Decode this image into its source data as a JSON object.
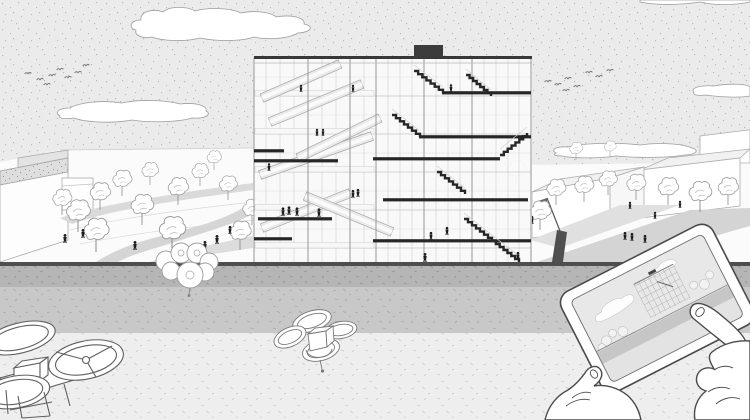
{
  "meta": {
    "title": "Architectural section-perspective illustration with plaza, drones and tablet overlay",
    "canvas": {
      "width": 750,
      "height": 420
    }
  },
  "palette": {
    "sky": "#ebebeb",
    "skyDot": "#aeaeae",
    "cloudFill": "#ffffff",
    "cloudStroke": "#9e9e9e",
    "ground": "#fbfbfb",
    "path": "#d5d5d5",
    "roof": "#dedede",
    "outline": "#a8a8a8",
    "slab": "#262626",
    "grid": "#c4c4c4",
    "gridDark": "#979797",
    "ramp": "#e9e9e9",
    "figure": "#1d1d1d",
    "treeStroke": "#9a9a9a",
    "edge": "#4e4e4e",
    "band1": "#b5b5b5",
    "band2": "#c8c8c8",
    "band3": "#eeeeee",
    "bandTick": "#a6a6a6",
    "droneStroke": "#5f5f5f",
    "handStroke": "#4a4a4a",
    "screenSky": "#e8e8e8",
    "screenBand": "#c6c6c6"
  },
  "sky": {
    "horizon_y": 263
  },
  "clouds": {
    "count": 5,
    "names": [
      "cloud-top-left",
      "cloud-mid-left",
      "cloud-right-low",
      "cloud-right-edge",
      "cloud-top-right-sliver"
    ]
  },
  "birds": {
    "flock_left": [
      [
        28,
        74
      ],
      [
        40,
        80
      ],
      [
        52,
        76
      ],
      [
        47,
        85
      ],
      [
        60,
        70
      ],
      [
        68,
        78
      ],
      [
        78,
        73
      ],
      [
        86,
        66
      ]
    ],
    "flock_right": [
      [
        548,
        82
      ],
      [
        558,
        85
      ],
      [
        568,
        79
      ],
      [
        577,
        87
      ],
      [
        589,
        73
      ],
      [
        599,
        77
      ],
      [
        610,
        71
      ],
      [
        566,
        91
      ]
    ]
  },
  "trees": {
    "left": [
      [
        62,
        215,
        0.8
      ],
      [
        78,
        232,
        1.0
      ],
      [
        100,
        210,
        0.85
      ],
      [
        122,
        196,
        0.8
      ],
      [
        96,
        252,
        1.05
      ],
      [
        142,
        225,
        0.95
      ],
      [
        150,
        185,
        0.7
      ],
      [
        172,
        252,
        1.1
      ],
      [
        178,
        205,
        0.85
      ],
      [
        200,
        186,
        0.7
      ],
      [
        214,
        170,
        0.6
      ],
      [
        228,
        200,
        0.75
      ],
      [
        240,
        250,
        0.9
      ],
      [
        252,
        225,
        0.8
      ]
    ],
    "right": [
      [
        516,
        185,
        0.75
      ],
      [
        540,
        230,
        0.9
      ],
      [
        556,
        205,
        0.8
      ],
      [
        584,
        202,
        0.8
      ],
      [
        608,
        195,
        0.75
      ],
      [
        636,
        200,
        0.8
      ],
      [
        668,
        205,
        0.85
      ],
      [
        700,
        212,
        0.95
      ],
      [
        728,
        205,
        0.85
      ],
      [
        576,
        160,
        0.55
      ],
      [
        610,
        157,
        0.5
      ]
    ]
  },
  "people": {
    "plaza_left": [
      [
        65,
        243,
        1
      ],
      [
        83,
        238,
        1
      ],
      [
        135,
        250,
        1
      ],
      [
        205,
        250,
        1
      ],
      [
        217,
        244,
        1
      ],
      [
        230,
        234,
        0.9
      ]
    ],
    "plaza_right": [
      [
        532,
        224,
        0.9
      ],
      [
        630,
        209,
        0.8
      ],
      [
        655,
        219,
        0.8
      ],
      [
        625,
        240,
        0.9
      ],
      [
        632,
        241,
        0.9
      ],
      [
        645,
        243,
        0.9
      ],
      [
        680,
        208,
        0.8
      ]
    ],
    "building": [
      [
        451,
        92,
        0.85
      ],
      [
        317,
        136,
        0.8
      ],
      [
        323,
        136,
        0.8
      ],
      [
        283,
        216,
        0.95
      ],
      [
        289,
        215,
        0.95
      ],
      [
        297,
        216,
        0.95
      ],
      [
        319,
        217,
        0.95
      ],
      [
        353,
        198,
        0.9
      ],
      [
        358,
        197,
        0.9
      ],
      [
        431,
        240,
        0.9
      ],
      [
        447,
        235,
        0.9
      ],
      [
        301,
        92,
        0.8
      ],
      [
        353,
        92,
        0.8
      ],
      [
        269,
        171,
        0.85
      ],
      [
        425,
        262,
        1.0
      ],
      [
        518,
        260,
        0.9
      ]
    ]
  },
  "building": {
    "bbox": [
      254,
      46,
      278,
      217
    ],
    "roof_y": 57,
    "roof_box": [
      414,
      45,
      29,
      12
    ],
    "columns_light": [
      254,
      266,
      280,
      294,
      308,
      322,
      336,
      350,
      364,
      376,
      388,
      400,
      412,
      424,
      436,
      448,
      460,
      472,
      484,
      496,
      508,
      519,
      531
    ],
    "columns_dark": [
      254,
      308,
      350,
      376,
      424,
      472,
      531
    ],
    "levels": [
      96,
      134,
      172,
      210,
      248
    ],
    "mid_lines": [
      77,
      115,
      153,
      191,
      229
    ],
    "slabs": [
      [
        442,
        531,
        93
      ],
      [
        419,
        531,
        137
      ],
      [
        373,
        500,
        159
      ],
      [
        383,
        528,
        200
      ],
      [
        373,
        531,
        241
      ],
      [
        254,
        338,
        161
      ],
      [
        254,
        284,
        151
      ],
      [
        258,
        332,
        219
      ],
      [
        254,
        292,
        239
      ]
    ],
    "stairs": [
      [
        414,
        71,
        443,
        93
      ],
      [
        466,
        75,
        491,
        96
      ],
      [
        392,
        115,
        420,
        137
      ],
      [
        437,
        172,
        465,
        194
      ],
      [
        500,
        155,
        527,
        133
      ],
      [
        464,
        219,
        492,
        241
      ],
      [
        492,
        241,
        519,
        262
      ]
    ],
    "ramps": [
      [
        260,
        175,
        372,
        136
      ],
      [
        262,
        228,
        350,
        193
      ],
      [
        305,
        196,
        392,
        232
      ],
      [
        270,
        122,
        362,
        84
      ],
      [
        262,
        98,
        340,
        64
      ],
      [
        298,
        158,
        380,
        118
      ]
    ]
  },
  "bands": {
    "edge_y": 262,
    "band1": [
      266,
      21
    ],
    "band2": [
      287,
      46
    ],
    "band3": [
      333,
      87
    ]
  },
  "drones": {
    "large": {
      "label": "quadcopter-drone-lower-left"
    },
    "mid": {
      "label": "quadcopter-drone-center-foreground"
    },
    "small": {
      "label": "small-rotor-drone-plaza-edge"
    }
  },
  "tablet": {
    "x": 556,
    "y": 297,
    "angle": -27,
    "width": 170,
    "height": 112,
    "corner_radius": 13,
    "bezel": 11,
    "screen_content": "miniature-of-same-building-scene"
  }
}
